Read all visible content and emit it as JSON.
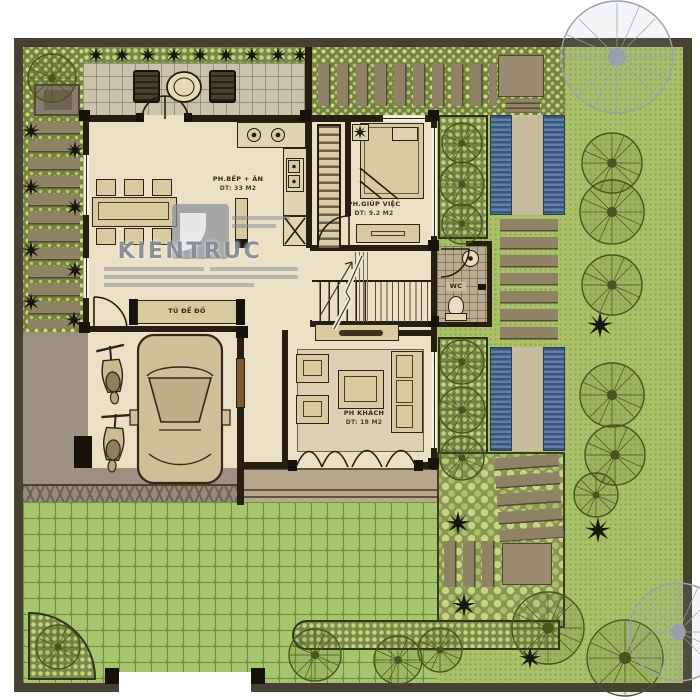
{
  "document": {
    "type": "villa-ground-floor-plan",
    "watermark": "KIENTRUC"
  },
  "rooms": {
    "kitchen_dining": {
      "name": "PH.BẾP + ĂN",
      "area": "DT: 33 M2"
    },
    "maid_room": {
      "name": "PH.GIÚP VIỆC",
      "area": "DT: 9.2 M2"
    },
    "living_room": {
      "name": "PH KHÁCH",
      "area": "DT: 18 M2"
    },
    "storage": {
      "name": "TỦ ĐỂ ĐỒ"
    },
    "wc": {
      "name": "WC"
    }
  },
  "colors": {
    "site_wall": "#474133",
    "interior_floor": "#e9e0c6",
    "lawn": "#aac169",
    "pavers": "#a7c56c",
    "pebble_bed": "#76823f",
    "water": "#3a577b",
    "stepping_stone": "#8f8265",
    "furniture": "#d8caa0",
    "garage_floor": "#9c9080",
    "terrace": "#b5a88e",
    "tree_line": "#49551f",
    "ink": "#241c0e",
    "watermark_gray": "#7d838f"
  }
}
